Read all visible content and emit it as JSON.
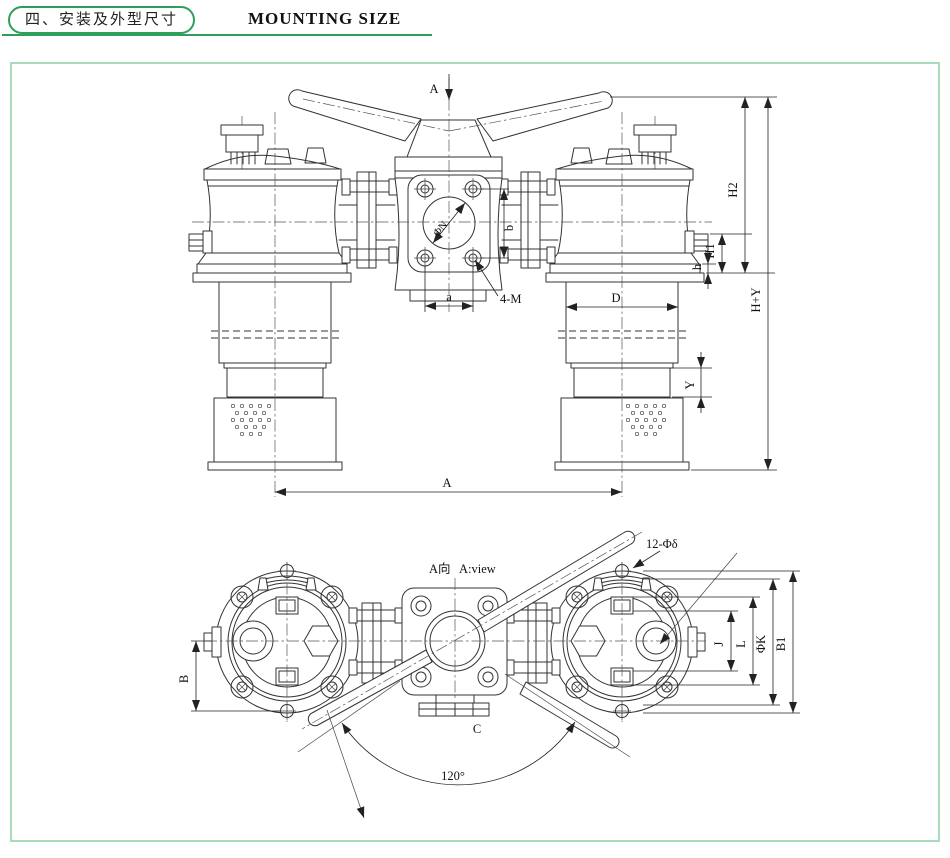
{
  "header": {
    "section_title_zh": "四、安装及外型尺寸",
    "title_en": "MOUNTING SIZE"
  },
  "front_view": {
    "view_arrow": "A",
    "labels": {
      "phiN": "ΦN",
      "b": "b",
      "a": "a",
      "fourM": "4-M",
      "D": "D",
      "Y": "Y",
      "A": "A",
      "h": "h",
      "H1": "H1",
      "H2": "H2",
      "HY": "H+Y"
    }
  },
  "plan_view": {
    "title_zh": "A向",
    "title_en": "A:view",
    "labels": {
      "holes": "12-Φδ",
      "B": "B",
      "J": "J",
      "L": "L",
      "phiK": "ΦK",
      "B1": "B1",
      "C": "C",
      "angle": "120°"
    }
  },
  "colors": {
    "accent_green": "#2e9e5b",
    "frame_mint": "#a8dabc",
    "line": "#333333"
  }
}
